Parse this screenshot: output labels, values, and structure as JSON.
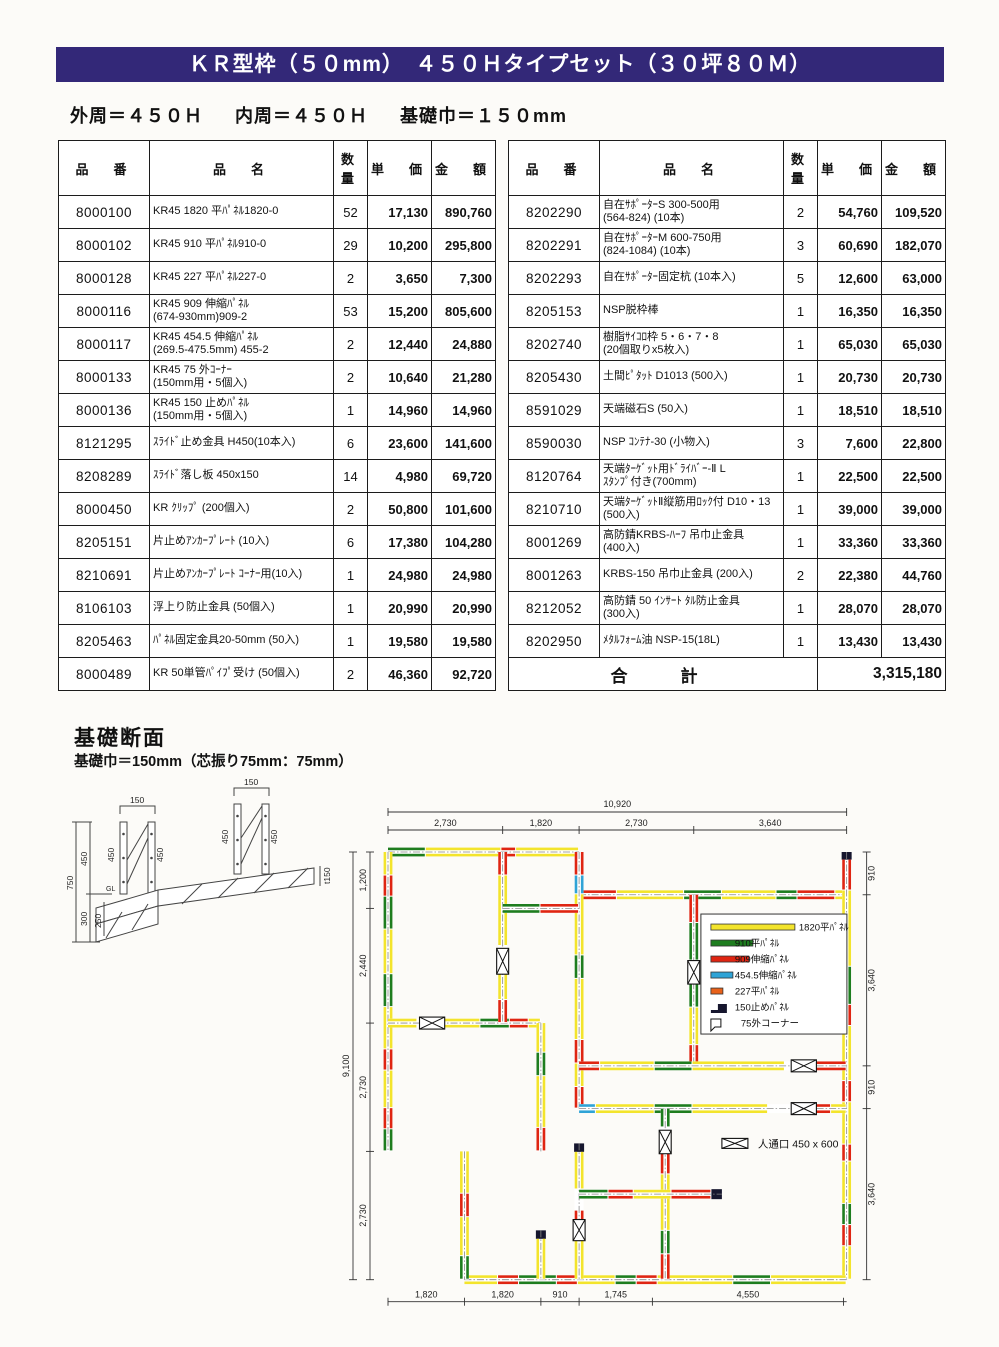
{
  "banner": {
    "title": "ＫＲ型枠（５０mm）　４５０Ｈタイプセット（３０坪８０Ｍ）"
  },
  "subtitle": {
    "outer": "外周＝４５０Ｈ",
    "inner": "内周＝４５０Ｈ",
    "width": "基礎巾＝１５０mm"
  },
  "headers": [
    "品　番",
    "品　名",
    "数量",
    "単　価",
    "金　額"
  ],
  "left_table": {
    "rows": [
      {
        "code": "8000100",
        "name": "KR45 1820 平ﾊﾟﾈﾙ1820-0",
        "qty": "52",
        "unit": "17,130",
        "amount": "890,760"
      },
      {
        "code": "8000102",
        "name": "KR45 910 平ﾊﾟﾈﾙ910-0",
        "qty": "29",
        "unit": "10,200",
        "amount": "295,800"
      },
      {
        "code": "8000128",
        "name": "KR45 227 平ﾊﾟﾈﾙ227-0",
        "qty": "2",
        "unit": "3,650",
        "amount": "7,300"
      },
      {
        "code": "8000116",
        "name": "KR45 909 伸縮ﾊﾟﾈﾙ\n(674-930mm)909-2",
        "qty": "53",
        "unit": "15,200",
        "amount": "805,600"
      },
      {
        "code": "8000117",
        "name": "KR45 454.5 伸縮ﾊﾟﾈﾙ\n(269.5-475.5mm) 455-2",
        "qty": "2",
        "unit": "12,440",
        "amount": "24,880"
      },
      {
        "code": "8000133",
        "name": "KR45 75 外ｺｰﾅｰ\n(150mm用・5個入)",
        "qty": "2",
        "unit": "10,640",
        "amount": "21,280"
      },
      {
        "code": "8000136",
        "name": "KR45 150 止めﾊﾟﾈﾙ\n(150mm用・5個入)",
        "qty": "1",
        "unit": "14,960",
        "amount": "14,960"
      },
      {
        "code": "8121295",
        "name": "ｽﾗｲﾄﾞ止め金具 H450(10本入)",
        "qty": "6",
        "unit": "23,600",
        "amount": "141,600"
      },
      {
        "code": "8208289",
        "name": "ｽﾗｲﾄﾞ落し板 450x150",
        "qty": "14",
        "unit": "4,980",
        "amount": "69,720"
      },
      {
        "code": "8000450",
        "name": "KR ｸﾘｯﾌﾟ (200個入)",
        "qty": "2",
        "unit": "50,800",
        "amount": "101,600"
      },
      {
        "code": "8205151",
        "name": "片止めｱﾝｶｰﾌﾟﾚｰﾄ (10入)",
        "qty": "6",
        "unit": "17,380",
        "amount": "104,280"
      },
      {
        "code": "8210691",
        "name": "片止めｱﾝｶｰﾌﾟﾚｰﾄ ｺｰﾅｰ用(10入)",
        "qty": "1",
        "unit": "24,980",
        "amount": "24,980"
      },
      {
        "code": "8106103",
        "name": "浮上り防止金具 (50個入)",
        "qty": "1",
        "unit": "20,990",
        "amount": "20,990"
      },
      {
        "code": "8205463",
        "name": "ﾊﾟﾈﾙ固定金具20-50mm (50入)",
        "qty": "1",
        "unit": "19,580",
        "amount": "19,580"
      },
      {
        "code": "8000489",
        "name": "KR 50単管ﾊﾟｲﾌﾟ受け (50個入)",
        "qty": "2",
        "unit": "46,360",
        "amount": "92,720"
      }
    ]
  },
  "right_table": {
    "rows": [
      {
        "code": "8202290",
        "name": "自在ｻﾎﾟｰﾀｰS 300-500用\n(564-824) (10本)",
        "qty": "2",
        "unit": "54,760",
        "amount": "109,520"
      },
      {
        "code": "8202291",
        "name": "自在ｻﾎﾟｰﾀｰM 600-750用\n(824-1084) (10本)",
        "qty": "3",
        "unit": "60,690",
        "amount": "182,070"
      },
      {
        "code": "8202293",
        "name": "自在ｻﾎﾟｰﾀｰ固定杭 (10本入)",
        "qty": "5",
        "unit": "12,600",
        "amount": "63,000"
      },
      {
        "code": "8205153",
        "name": "NSP脱枠棒",
        "qty": "1",
        "unit": "16,350",
        "amount": "16,350"
      },
      {
        "code": "8202740",
        "name": "樹脂ｻｲｺﾛ枠 5・6・7・8\n(20個取りx5枚入)",
        "qty": "1",
        "unit": "65,030",
        "amount": "65,030"
      },
      {
        "code": "8205430",
        "name": "土間ﾋﾟﾀｯﾄ D1013 (500入)",
        "qty": "1",
        "unit": "20,730",
        "amount": "20,730"
      },
      {
        "code": "8591029",
        "name": "天端磁石S (50入)",
        "qty": "1",
        "unit": "18,510",
        "amount": "18,510"
      },
      {
        "code": "8590030",
        "name": "NSP ｺﾝﾃﾅ-30 (小物入)",
        "qty": "3",
        "unit": "7,600",
        "amount": "22,800"
      },
      {
        "code": "8120764",
        "name": "天端ﾀｰｹﾞｯﾄ用ﾄﾞﾗｲﾊﾞｰ-Ⅱ L\nｽﾀﾝﾌﾟ付き(700mm)",
        "qty": "1",
        "unit": "22,500",
        "amount": "22,500"
      },
      {
        "code": "8210710",
        "name": "天端ﾀｰｹﾞｯﾄⅡ縦筋用ﾛｯｸ付 D10・13\n(500入)",
        "qty": "1",
        "unit": "39,000",
        "amount": "39,000"
      },
      {
        "code": "8001269",
        "name": "高防錆KRBS-ﾊｰﾌ 吊巾止金具\n(400入)",
        "qty": "1",
        "unit": "33,360",
        "amount": "33,360"
      },
      {
        "code": "8001263",
        "name": "KRBS-150 吊巾止金具 (200入)",
        "qty": "2",
        "unit": "22,380",
        "amount": "44,760"
      },
      {
        "code": "8212052",
        "name": "高防錆 50 ｲﾝｻｰﾄ ﾀﾙ防止金具\n(300入)",
        "qty": "1",
        "unit": "28,070",
        "amount": "28,070"
      },
      {
        "code": "8202950",
        "name": "ﾒﾀﾙﾌｫｰﾑ油 NSP-15(18L)",
        "qty": "1",
        "unit": "13,430",
        "amount": "13,430"
      }
    ],
    "total_label": "合　計",
    "total_amount": "3,315,180"
  },
  "section": {
    "title": "基礎断面",
    "sub": "基礎巾＝150mm（芯振り75mm：75mm）",
    "labels": {
      "w1": "150",
      "w2": "150",
      "p": "450",
      "total": "750",
      "upper": "450",
      "lower": "300",
      "inner": "250",
      "gl": "GL",
      "slab": "t150"
    }
  },
  "colors_map": {
    "Y": "#f3e42c",
    "G": "#1e7d1f",
    "R": "#df2512",
    "B": "#2fa3d6",
    "O": "#e8611a",
    "K": "#16162e"
  },
  "plan": {
    "walls": [
      {
        "d": "h",
        "x": 0,
        "y": 0,
        "len": 4.55,
        "segs": "G.9 Y1.8 R.35 Y1.5"
      },
      {
        "d": "h",
        "x": 4.55,
        "y": 0.91,
        "len": 6.37,
        "segs": "R.9 Y1.6 G.9 Y1.3 G.5 R.9 Y.27"
      },
      {
        "d": "v",
        "x": 10.92,
        "y": 0,
        "len": 9.1,
        "segs": "K.18 R.73 Y1.8 G.9 R.5 Y1.3 R.5 Y1.0 R.4 Y1.0 G.5 R.5 Y.79"
      },
      {
        "d": "h",
        "x": 1.82,
        "y": 9.1,
        "len": 9.1,
        "segs": "Y.8 R.5 G.9 R.5 Y.9 G.5 R.5 Y1.8 G.9 Y1.8"
      },
      {
        "d": "v",
        "x": 0,
        "y": 0,
        "len": 6.37,
        "segs": "Y.5 R.45 G.7 Y.95 G.7 Y.9 R.45 Y.8 R.45 G.47"
      },
      {
        "d": "h",
        "x": 0,
        "y": 3.64,
        "len": 3.64,
        "segs": "Y.7 W.6 Y.9 G.7 R.45 Y.29"
      },
      {
        "d": "v",
        "x": 2.73,
        "y": 0,
        "len": 3.64,
        "segs": "R.5 Y1.5 W.55 Y.6 R.49"
      },
      {
        "d": "v",
        "x": 3.64,
        "y": 3.64,
        "len": 2.73,
        "segs": "Y.63 G.5 Y1.1 R.5"
      },
      {
        "d": "v",
        "x": 4.55,
        "y": 0,
        "len": 5.46,
        "segs": "R.5 B.4 Y1.3 G.5 Y1.3 R.5 Y.5 R.46"
      },
      {
        "d": "h",
        "x": 2.73,
        "y": 1.2,
        "len": 1.82,
        "segs": "G.9 R.92"
      },
      {
        "d": "v",
        "x": 7.28,
        "y": 0.91,
        "len": 3.64,
        "segs": "R.6 G.8 W.5 G.5 Y.8 R.44"
      },
      {
        "d": "h",
        "x": 4.55,
        "y": 4.55,
        "len": 6.37,
        "segs": "R.5 Y1.3 G.9 Y2.2 W.6 R.87"
      },
      {
        "d": "h",
        "x": 4.55,
        "y": 5.46,
        "len": 6.37,
        "segs": "B.4 Y1.4 G.9 Y1.8 W.6 R.9 Y.37"
      },
      {
        "d": "v",
        "x": 6.6,
        "y": 5.46,
        "len": 3.64,
        "segs": "G.4 W.5 R.5 Y1.2 G.5 R.54"
      },
      {
        "d": "v",
        "x": 4.55,
        "y": 6.2,
        "len": 2.9,
        "segs": "K.18 Y.8 W.45 R.6 Y.87"
      },
      {
        "d": "h",
        "x": 4.55,
        "y": 7.28,
        "len": 3.4,
        "segs": "G.7 R.6 Y.9 R.95 K.25"
      },
      {
        "d": "v",
        "x": 3.64,
        "y": 8.05,
        "len": 1.05,
        "segs": "K.18 Y.87"
      },
      {
        "d": "v",
        "x": 1.82,
        "y": 6.37,
        "len": 2.73,
        "segs": "Y.9 R.5 Y.83 G.5"
      }
    ],
    "bowties": [
      {
        "d": "h",
        "x": 0.75,
        "y": 3.64,
        "len": 0.6
      },
      {
        "d": "v",
        "x": 2.73,
        "y": 2.05,
        "len": 0.55
      },
      {
        "d": "v",
        "x": 7.28,
        "y": 2.31,
        "len": 0.5
      },
      {
        "d": "h",
        "x": 9.6,
        "y": 4.55,
        "len": 0.6
      },
      {
        "d": "h",
        "x": 9.6,
        "y": 5.46,
        "len": 0.6
      },
      {
        "d": "v",
        "x": 6.6,
        "y": 5.92,
        "len": 0.5
      },
      {
        "d": "v",
        "x": 4.55,
        "y": 7.82,
        "len": 0.45
      }
    ],
    "legend": [
      {
        "key": "Y",
        "bar": 84,
        "label": "1820平ﾊﾟﾈﾙ"
      },
      {
        "key": "G",
        "bar": 42,
        "label": "910平ﾊﾟﾈﾙ"
      },
      {
        "key": "R",
        "bar": 38,
        "label": "909伸縮ﾊﾟﾈﾙ"
      },
      {
        "key": "B",
        "bar": 22,
        "label": "454.5伸縮ﾊﾟﾈﾙ"
      },
      {
        "key": "O",
        "bar": 12,
        "label": "227平ﾊﾟﾈﾙ"
      },
      {
        "key": "cap",
        "label": "150止めﾊﾟﾈﾙ"
      },
      {
        "key": "corner",
        "label": "75外コーナー"
      }
    ],
    "passage_label": "人通口  450 x 600",
    "dims": {
      "top_total": "10,920",
      "top": [
        "2,730",
        "1,820",
        "2,730",
        "3,640"
      ],
      "left_total": "9,100",
      "left": [
        "1,200",
        "2,440",
        "2,730",
        "2,730"
      ],
      "right": [
        "910",
        "3,640",
        "910",
        "3,640"
      ],
      "bottom": [
        "1,820",
        "1,820",
        "910",
        "1,745",
        "4,550"
      ]
    }
  }
}
